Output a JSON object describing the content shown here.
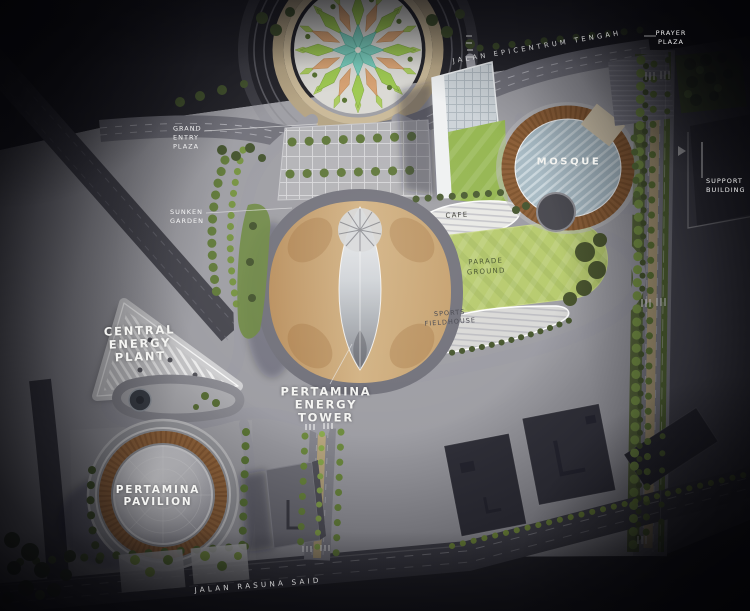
{
  "scene": {
    "roads": {
      "top": "JALAN EPICENTRUM TENGAH",
      "bottom": "JALAN RASUNA SAID"
    },
    "places": {
      "prayer_plaza": [
        "PRAYER",
        "PLAZA"
      ],
      "grand_entry_plaza": [
        "GRAND",
        "ENTRY",
        "PLAZA"
      ],
      "sunken_garden": [
        "SUNKEN",
        "GARDEN"
      ],
      "mosque": "MOSQUE",
      "support_building": [
        "SUPPORT",
        "BUILDING"
      ],
      "cafe": "CAFE",
      "parade_ground": [
        "PARADE",
        "GROUND"
      ],
      "sports_fieldhouse": [
        "SPORTS",
        "FIELDHOUSE"
      ],
      "central_energy_plant": [
        "CENTRAL",
        "ENERGY",
        "PLANT"
      ],
      "pertamina_energy_tower": [
        "PERTAMINA",
        "ENERGY",
        "TOWER"
      ],
      "pertamina_pavilion": [
        "PERTAMINA",
        "PAVILION"
      ]
    },
    "colors": {
      "background": "#26262c",
      "road_light": "#8c8c94",
      "asphalt_dark": "#46464e",
      "lawn": "#b6ca6c",
      "tree_dark": "#44552e",
      "tree_light": "#7d9b46",
      "tan_paving": "#c2a87e",
      "bronze_lattice": "#9c6b3e",
      "mosque_roof": "#a6b9c3",
      "star_teal": "#74c9b8",
      "star_orange": "#d6a070",
      "star_green": "#9cc84e",
      "tower_gold": "#c9a874",
      "label_white": "#f2f2f0"
    }
  }
}
